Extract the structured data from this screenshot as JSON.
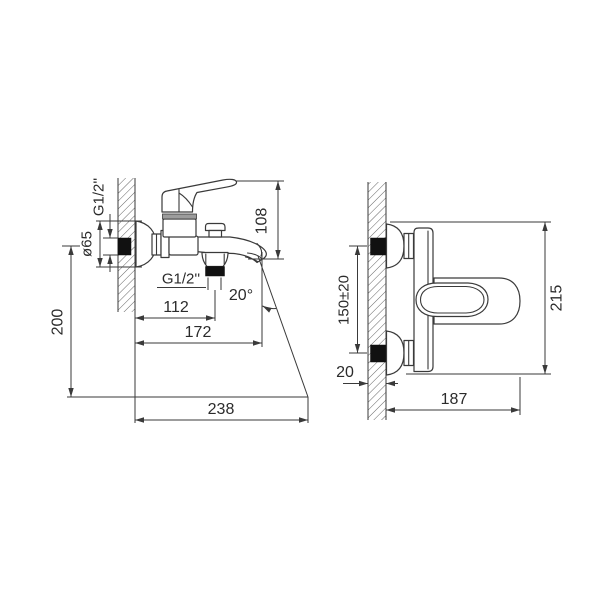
{
  "drawing": {
    "type": "technical-dimension-drawing",
    "subject": "wall-mounted bath mixer faucet, two orthographic views",
    "colors": {
      "line": "#3a3a3a",
      "solid_black": "#111111",
      "gray_band": "#9c9c9c",
      "background": "#ffffff"
    },
    "side_view": {
      "labels": {
        "wall_thread": "G1/2''",
        "flange_diameter": "ø65",
        "spout_height": "108",
        "mount_height": "200",
        "shower_outlet_thread": "G1/2''",
        "shower_outlet_offset": "112",
        "spout_reach": "172",
        "stream_angle": "20°",
        "stream_reach": "238"
      }
    },
    "top_view": {
      "labels": {
        "inlet_spacing": "150±20",
        "overall_width": "215",
        "wall_thickness": "20",
        "spout_projection": "187"
      }
    }
  }
}
